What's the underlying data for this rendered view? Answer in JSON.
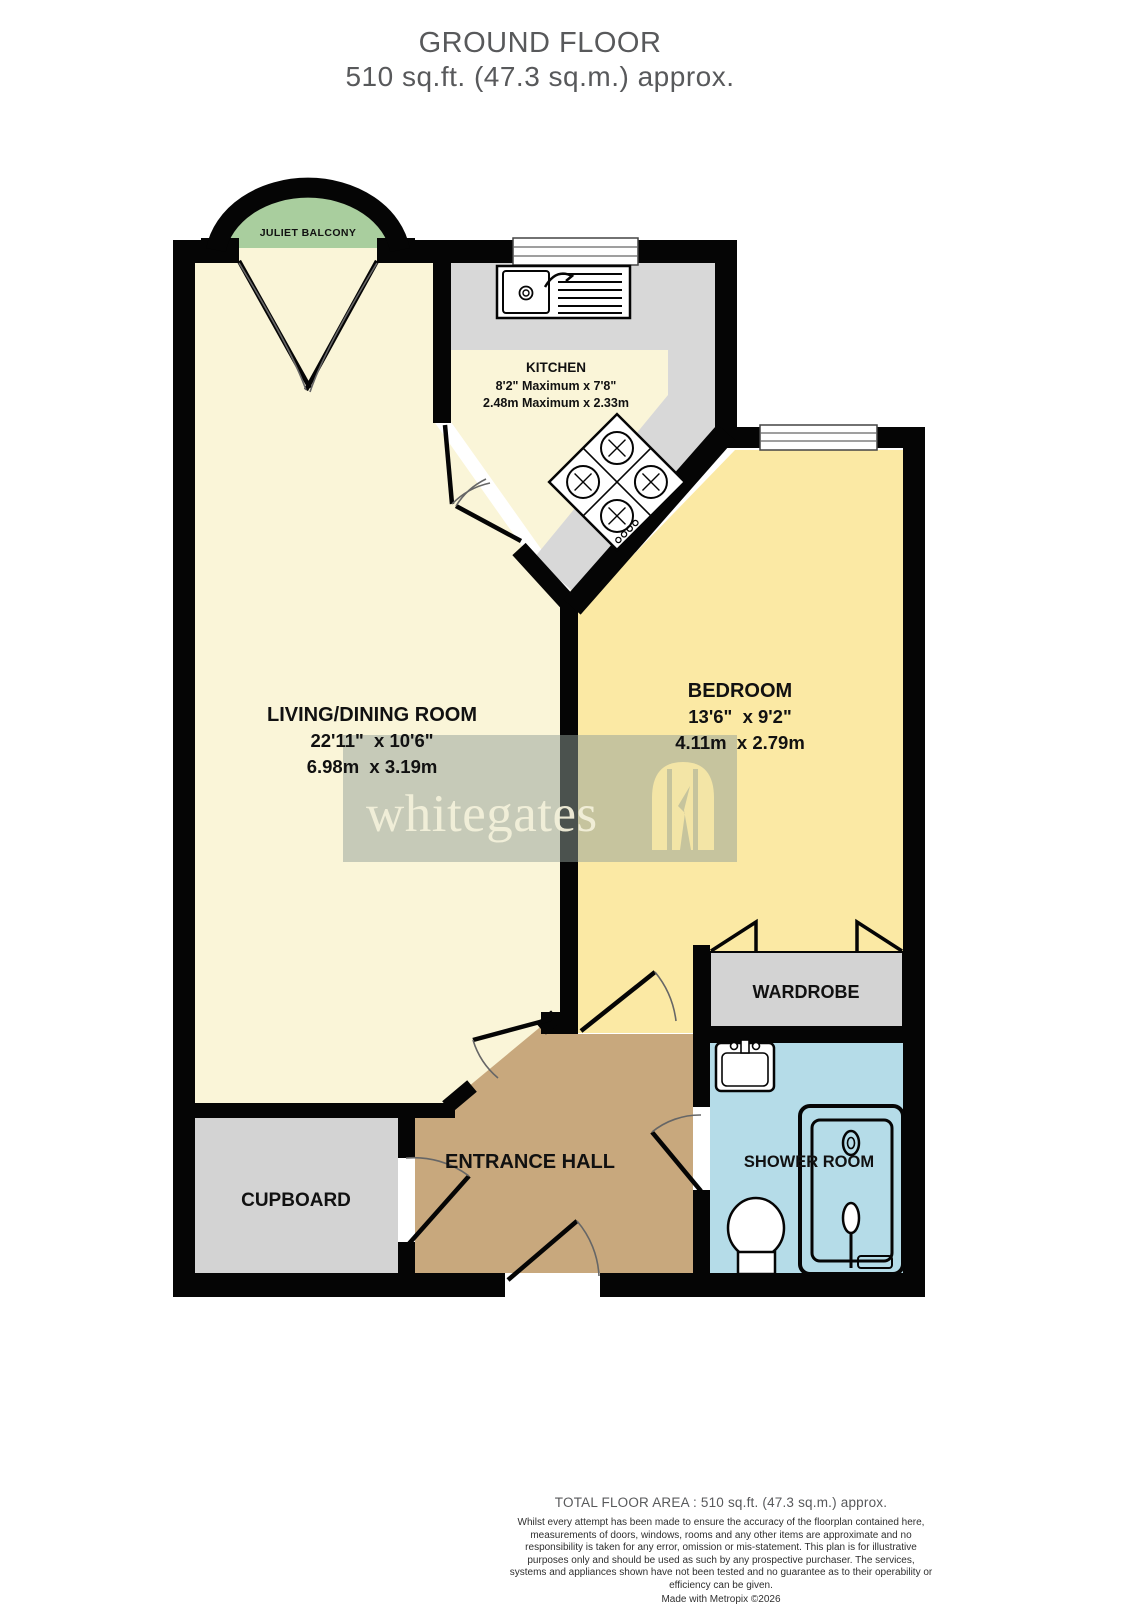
{
  "title": {
    "line1": "GROUND FLOOR",
    "line2": "510 sq.ft. (47.3 sq.m.) approx."
  },
  "rooms": {
    "juliet_balcony": {
      "name": "JULIET BALCONY"
    },
    "kitchen": {
      "name": "KITCHEN",
      "dims_imperial": "8'2\" Maximum x 7'8\"",
      "dims_metric": "2.48m Maximum x 2.33m"
    },
    "living_dining": {
      "name": "LIVING/DINING ROOM",
      "dims_imperial": "22'11\"  x 10'6\"",
      "dims_metric": "6.98m  x 3.19m"
    },
    "bedroom": {
      "name": "BEDROOM",
      "dims_imperial": "13'6\"  x 9'2\"",
      "dims_metric": "4.11m  x 2.79m"
    },
    "wardrobe": {
      "name": "WARDROBE"
    },
    "cupboard": {
      "name": "CUPBOARD"
    },
    "entrance_hall": {
      "name": "ENTRANCE HALL"
    },
    "shower_room": {
      "name": "SHOWER ROOM"
    }
  },
  "watermark": {
    "brand": "whitegates"
  },
  "footer": {
    "total_area": "TOTAL FLOOR AREA : 510 sq.ft. (47.3 sq.m.) approx.",
    "disclaimer": "Whilst every attempt has been made to ensure the accuracy of the floorplan contained here, measurements of doors, windows, rooms and any other items are approximate and no responsibility is taken for any error, omission or mis-statement. This plan is for illustrative purposes only and should be used as such by any prospective purchaser. The services, systems and appliances shown have not been tested and no guarantee as to their operability or efficiency can be given.",
    "credit": "Made with Metropix ©2026"
  },
  "colors": {
    "living_kitchen_floor": "#FAF5D8",
    "bedroom_floor": "#FBE9A4",
    "hall_floor": "#C8A87D",
    "shower_floor": "#B5DCE8",
    "storage_gray": "#D3D3D3",
    "counter_gray": "#D8D8D8",
    "balcony_green": "#A9CE9E",
    "wall": "#050505",
    "title_text": "#58595B"
  }
}
